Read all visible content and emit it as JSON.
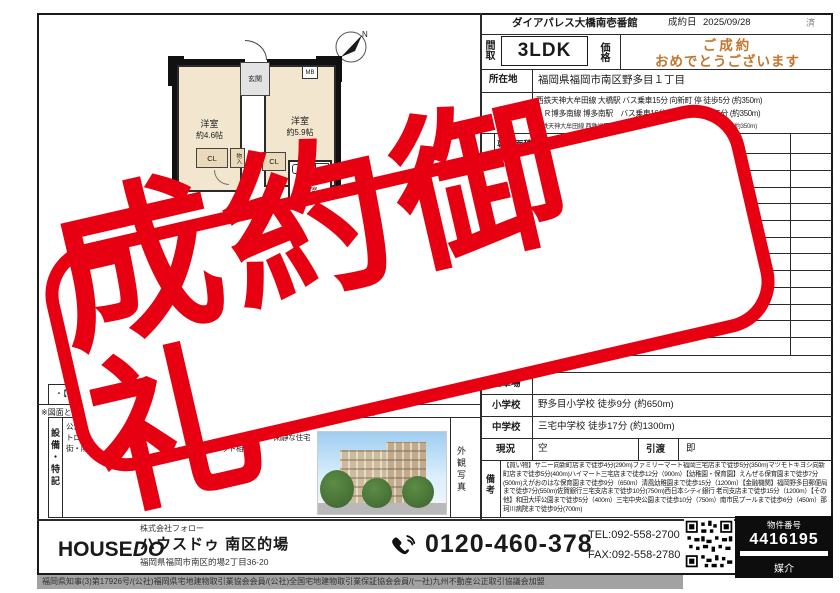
{
  "stamp": {
    "text": "成約御礼"
  },
  "header": {
    "building": "ダイアパレス大橋南壱番館",
    "date_label": "成約日",
    "date": "2025/09/28",
    "status": "済"
  },
  "summary": {
    "madori_label": "間取",
    "madori": "3LDK",
    "price_label": "価格",
    "congrats1": "ご成約",
    "congrats2": "おめでとうございます"
  },
  "rows": {
    "address_label": "所在地",
    "address": "福岡県福岡市南区野多目１丁目",
    "traffic_label": "交通",
    "traffic1": "西鉄天神大牟田線 大橋駅 バス乗車15分 向新町 停 徒歩5分 (約350m)",
    "traffic2": "ＪＲ博多南線 博多南駅　バス乗車16分 向新町 停 徒歩5分 (約350m)",
    "traffic3": "西鉄天神大牟田線 西鉄福岡（天神）駅　バス乗車30分 向新町 停 徒歩5分 (約350m)",
    "section_label": "部",
    "area_label": "専有面積",
    "area": "67.8㎡",
    "floor_label": "所在階",
    "zoning_label": "用途地域",
    "zoning": "1種住居",
    "parking_label": "駐車場",
    "elementary_label": "小学校",
    "elementary": "野多目小学校 徒歩9分 (約650m)",
    "junior_label": "中学校",
    "junior": "三宅中学校 徒歩17分 (約1300m)",
    "status_label": "現況",
    "status": "空",
    "handover_label": "引渡",
    "handover": "即",
    "remarks_label": "備考",
    "remarks": "【買い物】サニー向新町店まで徒歩4分(290m)ファミリーマート福岡三宅店まで徒歩5分(350m)マツモトキヨシ向新町店まで徒歩5分(400m)ハイマート三宅店まで徒歩12分（900m）【幼稚園・保育園】えんぜる保育園まで徒歩7分(500m)えがおのはな保育園まで徒歩9分（650m）清風幼稚園まで徒歩15分（1200m）【金融機関】福岡野多目郵便局まで徒歩7分(550m)佐賀銀行三宅支店まで徒歩10分(750m)西日本シティ銀行 老司支店まで徒歩15分（1200m）【その他】和田大坪公園まで徒歩5分（400m）三宅中央公園まで徒歩10分（750m）南市民プールまで徒歩6分（450m）那珂川病院まで徒歩9分(700m)"
  },
  "floorplan": {
    "genkan": "玄関",
    "room1": "洋室",
    "room1_size": "約4.6帖",
    "room2": "洋室",
    "room2_size": "約5.9帖",
    "mb": "MB",
    "cl1": "CL",
    "cl2": "CL",
    "monoire": "物入",
    "washroom1": "洗面所",
    "washroom2": "脱衣室",
    "toilet": "トイレ",
    "compass_n": "N"
  },
  "left_notes": {
    "mizumawari": "・【水回り】:2018",
    "zumen": "※図面と現況に相違",
    "zumen_end": "ください。",
    "equipment_label": "設備・特記",
    "equipment_text": "公営水道・都市ガス・キッチン・浴室・追焚機能・洗面所・カメラ・オートロック・小学校徒歩10分以内・便利用可・スーパーが近い・閑静な住宅街・陽当り良好・通風良好・外観タイル張・ペット相談",
    "photo_label": "外観写真"
  },
  "footer": {
    "company": "株式会社フォロー",
    "logo_house": "HOUSE",
    "logo_do": "DO",
    "shop": "ハウスドゥ 南区的場",
    "address": "福岡県福岡市南区的場2丁目36-20",
    "freedial": "0120-460-378",
    "tel": "TEL:092-558-2700",
    "fax": "FAX:092-558-2780",
    "bukken_label": "物件番号",
    "bukken_no": "4416195",
    "deal": "媒介"
  },
  "license": "福岡県知事(3)第17926号/(公社)福岡県宅地建物取引業協会会員/(公社)全国宅地建物取引業保証協会会員/(一社)九州不動産公正取引協議会加盟",
  "colors": {
    "stamp_red": "#e60012",
    "congrats_orange": "#c4752e"
  }
}
